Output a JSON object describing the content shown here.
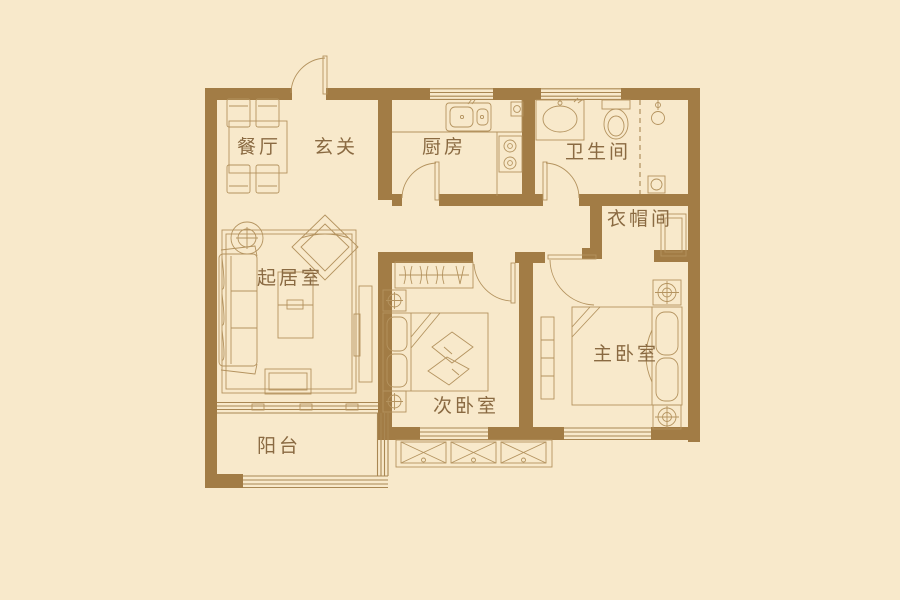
{
  "floorplan": {
    "colors": {
      "background": "#f8e9cb",
      "wall": "#a27c45",
      "furniture_line": "#ad8b58",
      "label_text": "#8a6a42"
    },
    "rooms": [
      {
        "id": "dining-room",
        "label": "餐厅"
      },
      {
        "id": "foyer",
        "label": "玄关"
      },
      {
        "id": "kitchen",
        "label": "厨房"
      },
      {
        "id": "bathroom",
        "label": "卫生间"
      },
      {
        "id": "cloakroom",
        "label": "衣帽间"
      },
      {
        "id": "living-room",
        "label": "起居室"
      },
      {
        "id": "second-bedroom",
        "label": "次卧室"
      },
      {
        "id": "master-bedroom",
        "label": "主卧室"
      },
      {
        "id": "balcony",
        "label": "阳台"
      }
    ]
  }
}
